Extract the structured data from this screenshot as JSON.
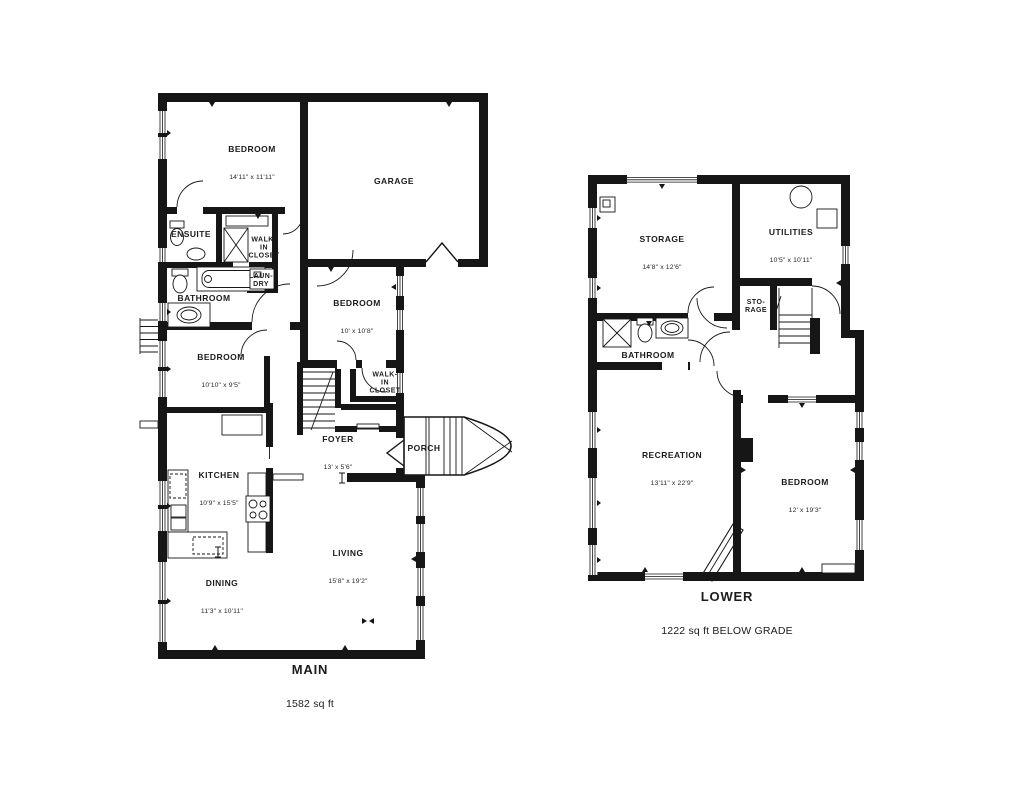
{
  "page": {
    "background": "#ffffff",
    "wall_color": "#161616",
    "text_color": "#1c1c1c"
  },
  "floors": [
    {
      "id": "main",
      "title": "MAIN",
      "area": "1582 sq ft",
      "rooms": [
        {
          "name": "BEDROOM",
          "dims": "14'11\" x 11'11\""
        },
        {
          "name": "GARAGE",
          "dims": ""
        },
        {
          "name": "ENSUITE",
          "dims": ""
        },
        {
          "name": "WALK-\nIN\nCLOSET",
          "dims": ""
        },
        {
          "name": "LAUN-\nDRY",
          "dims": ""
        },
        {
          "name": "BATHROOM",
          "dims": ""
        },
        {
          "name": "BEDROOM",
          "dims": "10' x 10'8\""
        },
        {
          "name": "BEDROOM",
          "dims": "10'10\" x 9'5\""
        },
        {
          "name": "WALK-\nIN\nCLOSET",
          "dims": ""
        },
        {
          "name": "FOYER",
          "dims": "13' x 5'6\""
        },
        {
          "name": "PORCH",
          "dims": ""
        },
        {
          "name": "KITCHEN",
          "dims": "10'9\" x 15'5\""
        },
        {
          "name": "LIVING",
          "dims": "15'8\" x 19'2\""
        },
        {
          "name": "DINING",
          "dims": "11'3\" x 10'11\""
        }
      ]
    },
    {
      "id": "lower",
      "title": "LOWER",
      "area": "1222 sq ft BELOW GRADE",
      "rooms": [
        {
          "name": "STORAGE",
          "dims": "14'8\" x 12'6\""
        },
        {
          "name": "UTILITIES",
          "dims": "10'5\" x 10'11\""
        },
        {
          "name": "STO-\nRAGE",
          "dims": ""
        },
        {
          "name": "BATHROOM",
          "dims": ""
        },
        {
          "name": "RECREATION",
          "dims": "13'11\" x 22'9\""
        },
        {
          "name": "BEDROOM",
          "dims": "12' x 19'3\""
        }
      ]
    }
  ]
}
